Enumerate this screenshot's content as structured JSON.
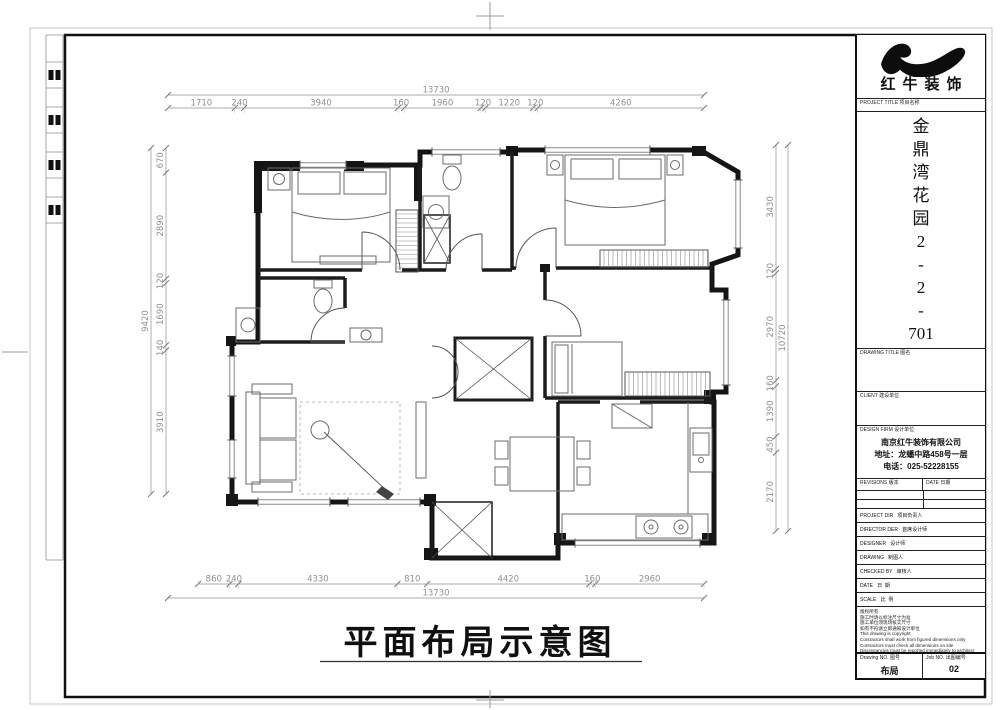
{
  "sheet": {
    "main_title": "平面布局示意图"
  },
  "dimensions": {
    "top": {
      "overall": "13730",
      "segments": [
        "1710",
        "240",
        "3940",
        "160",
        "1960",
        "120",
        "1220",
        "120",
        "4260"
      ]
    },
    "bottom": {
      "overall": "13730",
      "segments": [
        "860",
        "240",
        "4330",
        "810",
        "4420",
        "160",
        "2960"
      ]
    },
    "left": {
      "overall": "9420",
      "segments": [
        "670",
        "2890",
        "120",
        "1690",
        "140",
        "3910"
      ]
    },
    "right": {
      "overall": "10720",
      "segments": [
        "3430",
        "120",
        "2970",
        "160",
        "1390",
        "450",
        "2170"
      ]
    }
  },
  "title_block": {
    "brand": "红牛装饰",
    "project_title_label": "PROJECT TITLE  项目名称",
    "project_title": "金鼎湾花园2-2-701",
    "drawing_title_label": "DRAWING TITLE  图名",
    "client_label": "CLIENT  建设单位",
    "design_firm_label": "DESIGN FIRM  设计单位",
    "design_firm_lines": [
      "南京红牛装饰有限公司",
      "地址：龙蟠中路458号一层",
      "电话：025-52228155"
    ],
    "revisions_label": "REVISIONS  版本",
    "date_col_label": "DATE  日期",
    "personnel_rows": [
      "PROJECT DIR   项目负责人",
      "DIRECTOR DER   首席设计师",
      "DESIGNER   设计师",
      "DRAWING   制图人",
      "CHECKED BY   审核人",
      "DATE   日  期",
      "SCALE   比  例"
    ],
    "notes": [
      "版权所有",
      "施工时请以标注尺寸为准",
      "施工单位须现场核实尺寸",
      "如有不符请立即通知设计单位",
      "This drawing is copyright",
      "Contractors shall work from figured dimensions only",
      "Contractors must check all dimensions on site",
      "Discrepancies must be reported immediately to architect"
    ],
    "drawing_no_label": "Drawing NO. 图号",
    "drawing_no_value": "布局",
    "job_no_label": "Job NO. 出图编号",
    "job_no_value": "02"
  }
}
